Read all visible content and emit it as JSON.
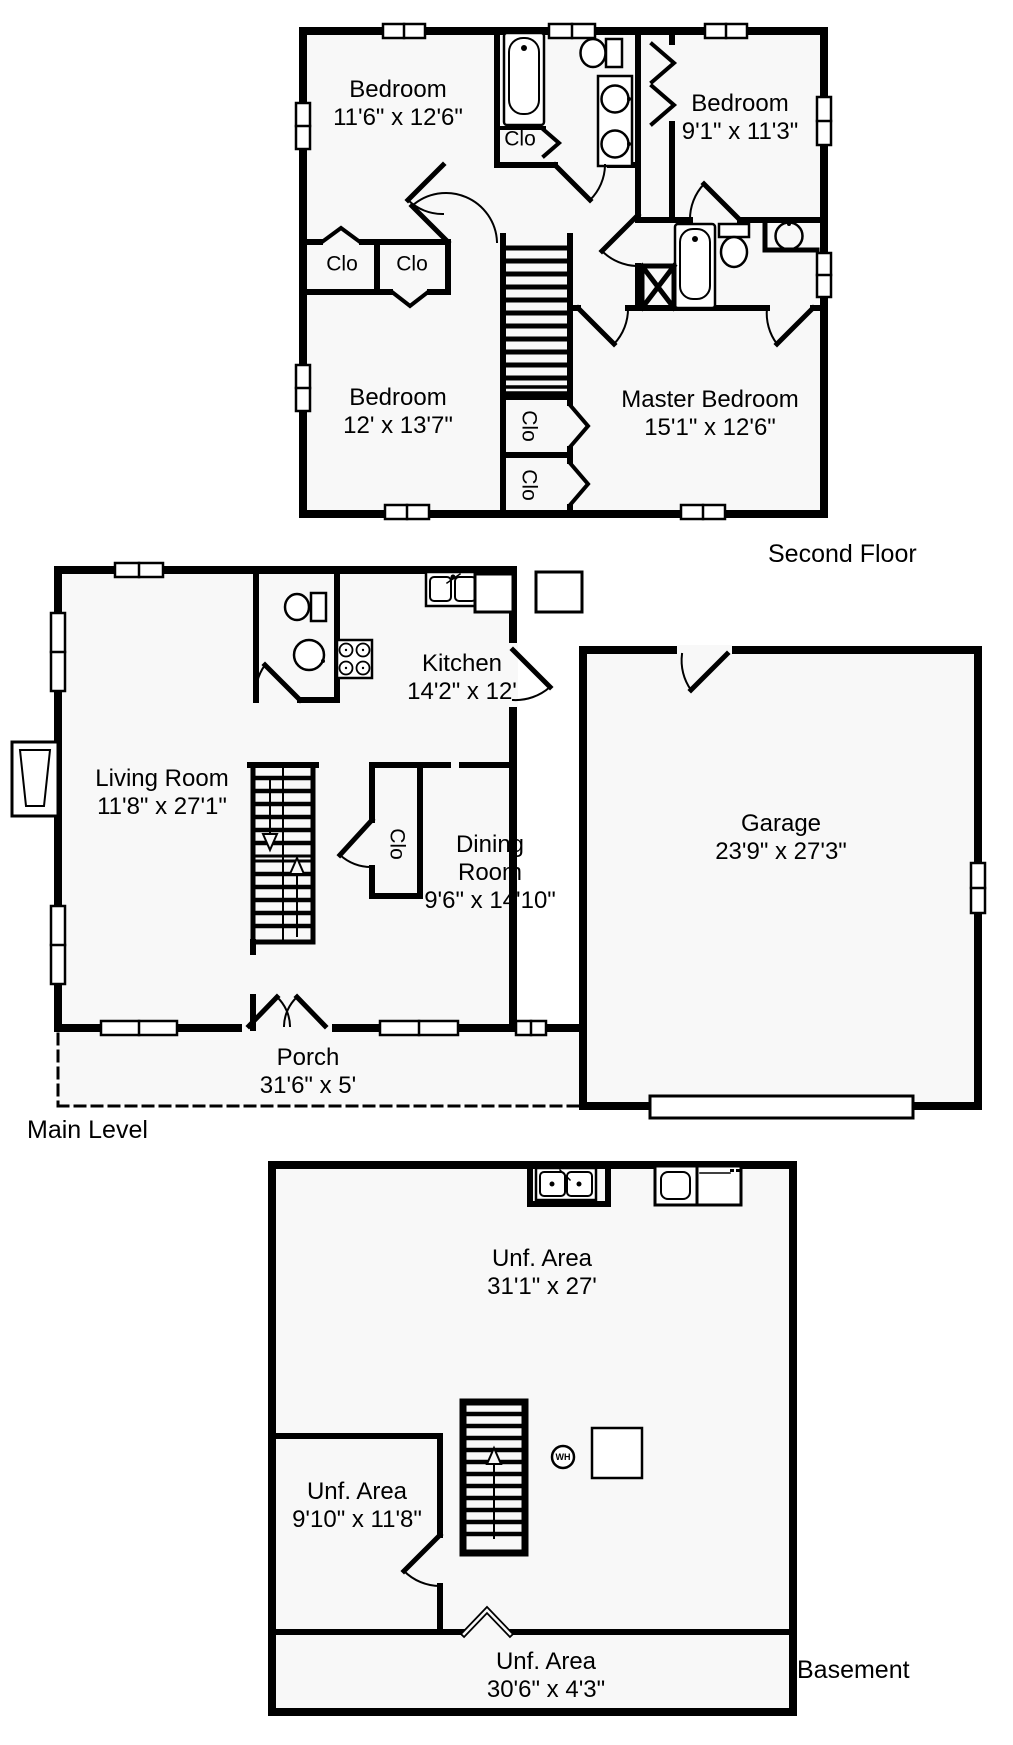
{
  "palette": {
    "ink": "#000000",
    "floor_fill": "#f8f8f8",
    "background": "#ffffff"
  },
  "floors": {
    "second": {
      "title": "Second Floor",
      "rooms": {
        "bedroom1": {
          "name": "Bedroom",
          "dims": "11'6\" x 12'6\""
        },
        "bedroom2": {
          "name": "Bedroom",
          "dims": "9'1\" x 11'3\""
        },
        "bedroom3": {
          "name": "Bedroom",
          "dims": "12' x 13'7\""
        },
        "master": {
          "name": "Master Bedroom",
          "dims": "15'1\" x 12'6\""
        }
      },
      "closets": {
        "bath": "Clo",
        "left1": "Clo",
        "left2": "Clo",
        "stair1": "Clo",
        "stair2": "Clo"
      }
    },
    "main": {
      "title": "Main Level",
      "rooms": {
        "living": {
          "name": "Living Room",
          "dims": "11'8\" x 27'1\""
        },
        "kitchen": {
          "name": "Kitchen",
          "dims": "14'2\" x 12'"
        },
        "dining": {
          "name": "Dining Room",
          "dims": "9'6\" x 14'10\""
        },
        "garage": {
          "name": "Garage",
          "dims": "23'9\" x 27'3\""
        },
        "porch": {
          "name": "Porch",
          "dims": "31'6\" x 5'"
        }
      },
      "closets": {
        "hall": "Clo"
      }
    },
    "basement": {
      "title": "Basement",
      "rooms": {
        "unf_main": {
          "name": "Unf. Area",
          "dims": "31'1\" x 27'"
        },
        "unf_small": {
          "name": "Unf. Area",
          "dims": "9'10\" x 11'8\""
        },
        "unf_strip": {
          "name": "Unf. Area",
          "dims": "30'6\" x 4'3\""
        }
      },
      "water_heater": "WH"
    }
  }
}
